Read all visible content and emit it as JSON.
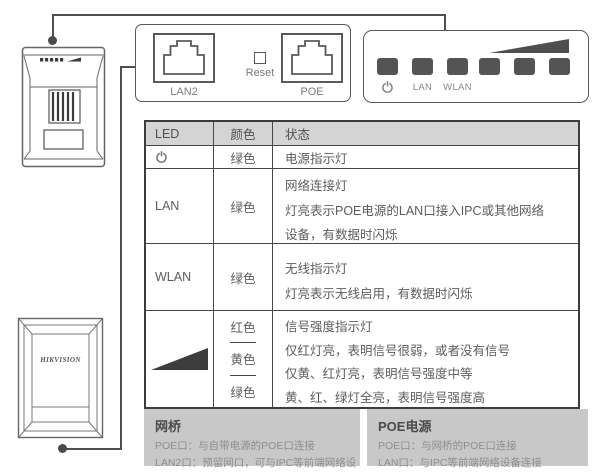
{
  "ports_panel": {
    "lan2": "LAN2",
    "reset": "Reset",
    "poe": "POE"
  },
  "led_panel": {
    "lan": "LAN",
    "wlan": "WLAN"
  },
  "front_device": {
    "brand": "HIKVISION"
  },
  "table": {
    "header": {
      "led": "LED",
      "color": "颜色",
      "status": "状态"
    },
    "row_power": {
      "color": "绿色",
      "status": "电源指示灯"
    },
    "row_lan": {
      "led": "LAN",
      "color": "绿色",
      "status": "网络连接灯\n灯亮表示POE电源的LAN口接入IPC或其他网络\n设备，有数据时闪烁"
    },
    "row_wlan": {
      "led": "WLAN",
      "color": "绿色",
      "status": "无线指示灯\n灯亮表示无线启用，有数据时闪烁"
    },
    "row_signal": {
      "colors": [
        "红色",
        "黄色",
        "绿色"
      ],
      "status": "信号强度指示灯\n仅红灯亮，表明信号很弱，或者没有信号\n仅黄、红灯亮，表明信号强度中等\n黄、红、绿灯全亮，表明信号强度高"
    }
  },
  "bridge_box": {
    "title": "网桥",
    "lines": "POE口：与自带电源的POE口连接\nLAN2口：预留网口，可与IPC等前端网络设备连接"
  },
  "poe_box": {
    "title": "POE电源",
    "lines": "POE口：与网桥的POE口连接\nLAN口：与IPC等前端网络设备连接"
  },
  "colors": {
    "line": "#4f4f4f",
    "led_square": "#545454",
    "header_bg": "#d4d4d4",
    "box_bg": "#c8c8c8",
    "border": "#3c3c3c",
    "text": "#5c5c5c",
    "muted": "#8e8e8e"
  }
}
